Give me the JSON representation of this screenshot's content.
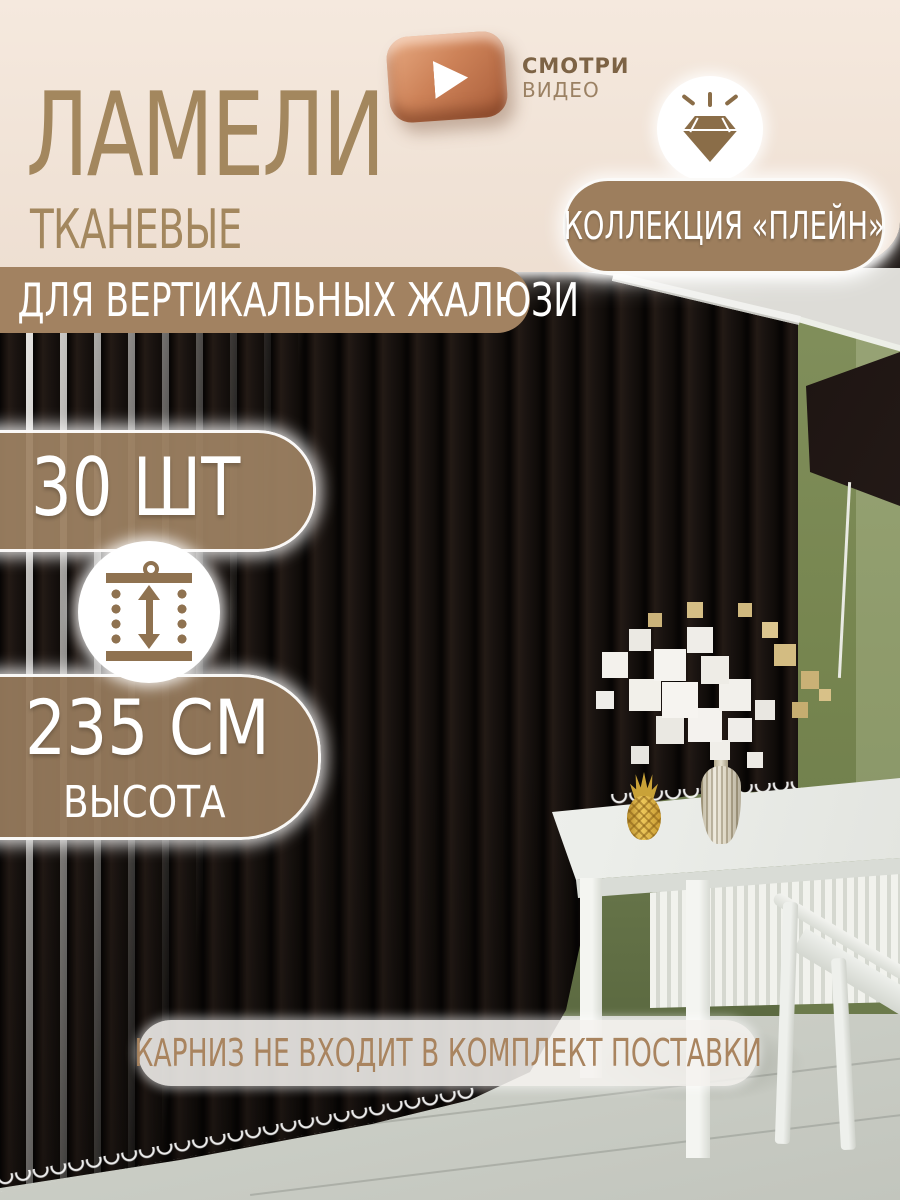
{
  "title": {
    "main": "ЛАМЕЛИ",
    "sub": "ТКАНЕВЫЕ"
  },
  "banner": {
    "text": "ДЛЯ ВЕРТИКАЛЬНЫХ ЖАЛЮЗИ"
  },
  "video_badge": {
    "line1": "СМОТРИ",
    "line2": "ВИДЕО"
  },
  "collection": {
    "text": "КОЛЛЕКЦИЯ «ПЛЕЙН»"
  },
  "quantity": {
    "text": "30 ШТ"
  },
  "height": {
    "value": "235 СМ",
    "label": "ВЫСОТА"
  },
  "note": {
    "text": "КАРНИЗ НЕ ВХОДИТ В КОМПЛЕКТ ПОСТАВКИ"
  },
  "icons": {
    "play": "play-icon",
    "diamond": "diamond-icon",
    "height": "height-measure-icon"
  },
  "colors": {
    "cream_header": "#f2e5d9",
    "accent_brown": "#a28261",
    "title_brown": "#a3875e",
    "pill_brown": "rgba(155,127,97,0.93)",
    "copper_button": "#c97a52",
    "note_text": "#a9845f",
    "wall_green": "#76854f",
    "blinds_dark": "#17110e",
    "text_white": "#ffffff"
  }
}
